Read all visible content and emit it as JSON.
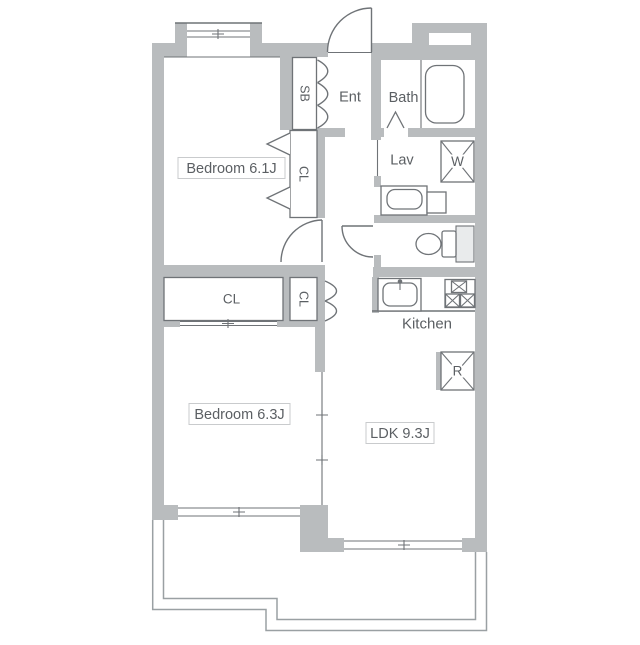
{
  "floorplan": {
    "type": "apartment-floor-plan",
    "labels": {
      "bedroom1": "Bedroom 6.1J",
      "bedroom2": "Bedroom 6.3J",
      "ldk": "LDK 9.3J",
      "kitchen": "Kitchen",
      "bath": "Bath",
      "lav": "Lav",
      "ent": "Ent",
      "shoe_box": "SB",
      "closet_bedroom1": "CL",
      "closet_hall": "CL",
      "closet_hall_small": "CL",
      "washing_machine": "W",
      "refrigerator": "R"
    },
    "colors": {
      "wall": "#b9bcbe",
      "line": "#6f7377",
      "balcony_line": "#9aa0a3",
      "text": "#5b5f63",
      "label_box_border": "#c9cbcd",
      "label_box_fill": "#ffffff",
      "background": "#ffffff"
    }
  }
}
